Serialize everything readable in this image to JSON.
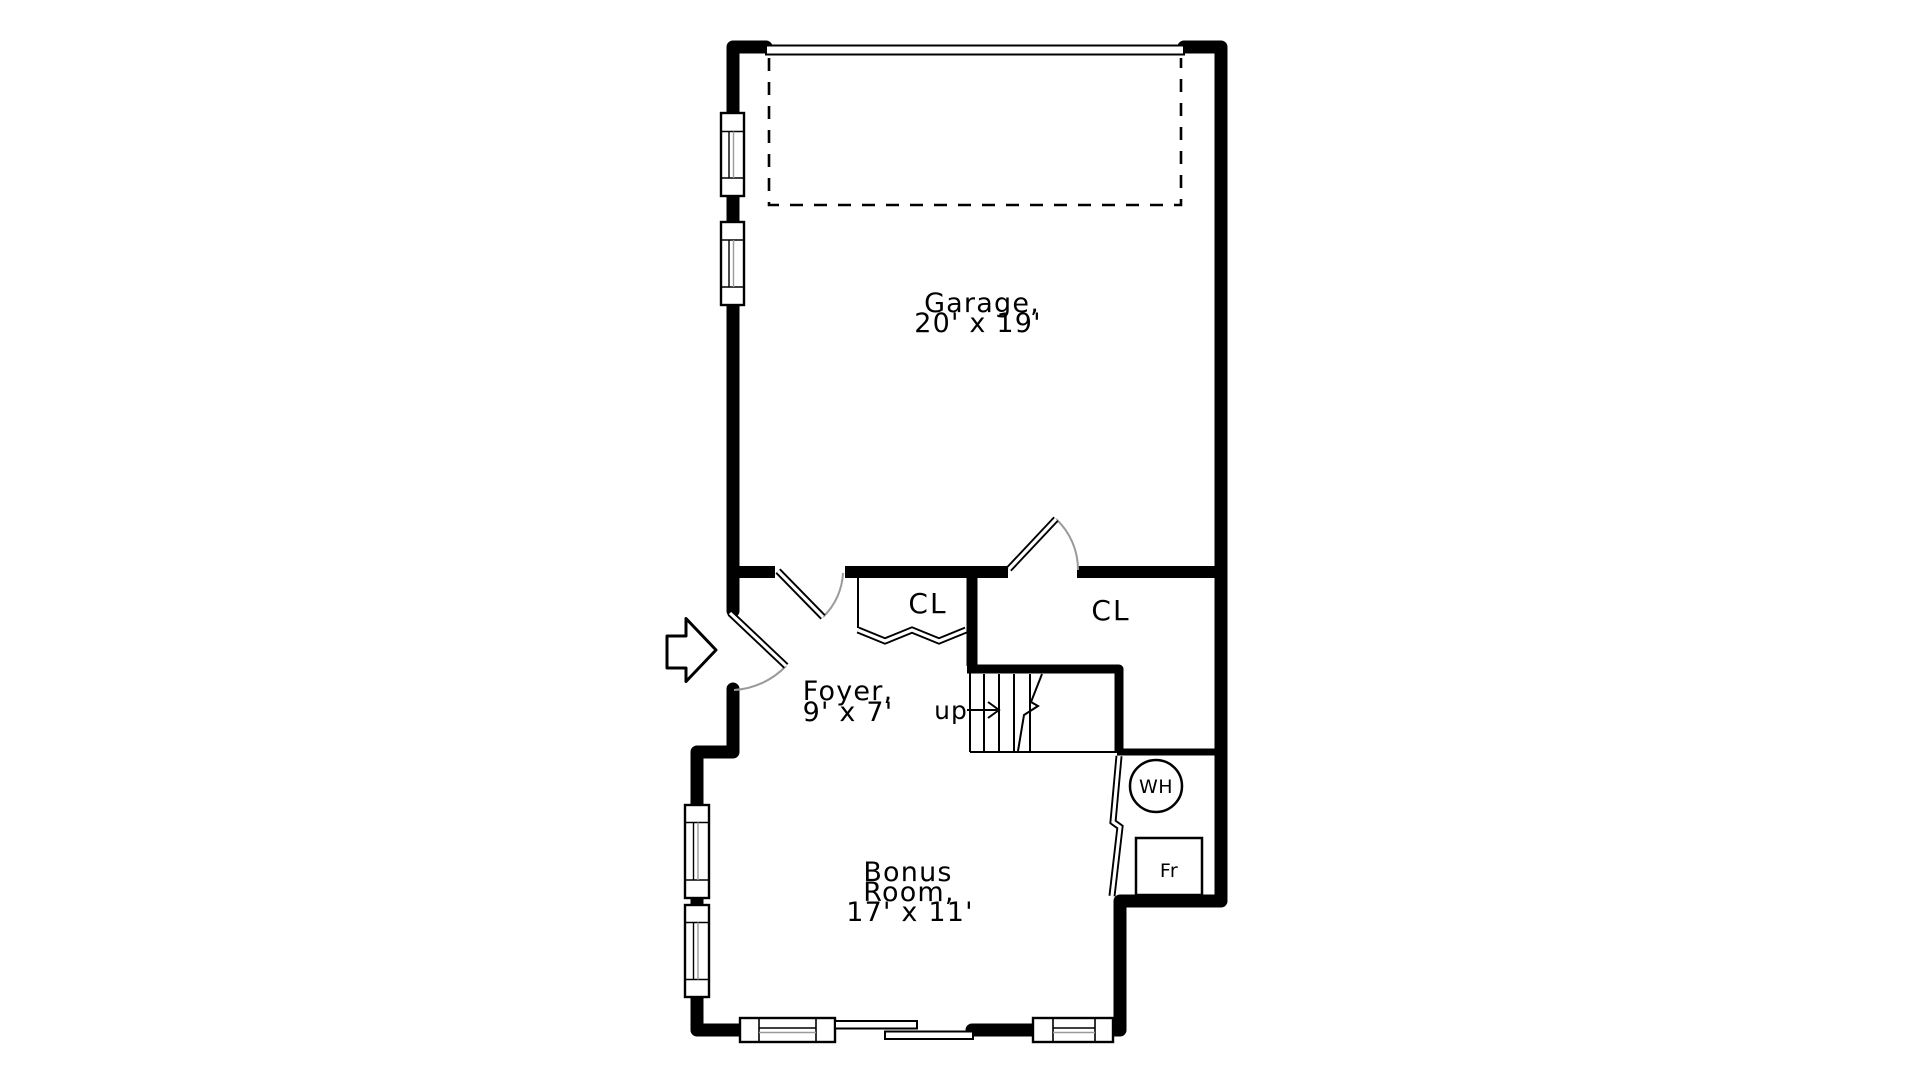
{
  "colors": {
    "background": "#ffffff",
    "walls": "#000000",
    "door_swing_arc": "#9a9a9a",
    "glazing_line": "#9a9a9a"
  },
  "floor_plan": {
    "rooms": {
      "garage": {
        "name": "Garage,",
        "dims": "20' x 19'"
      },
      "foyer": {
        "name": "Foyer,",
        "dims": "9' x 7'"
      },
      "bonus_room": {
        "name_line1": "Bonus",
        "name_line2": "Room,",
        "dims": "17' x 11'"
      },
      "closet_left": {
        "name": "CL"
      },
      "closet_right": {
        "name": "CL"
      }
    },
    "stairs": {
      "direction_label": "up"
    },
    "fixtures": {
      "water_heater": "WH",
      "freezer": "Fr"
    }
  }
}
